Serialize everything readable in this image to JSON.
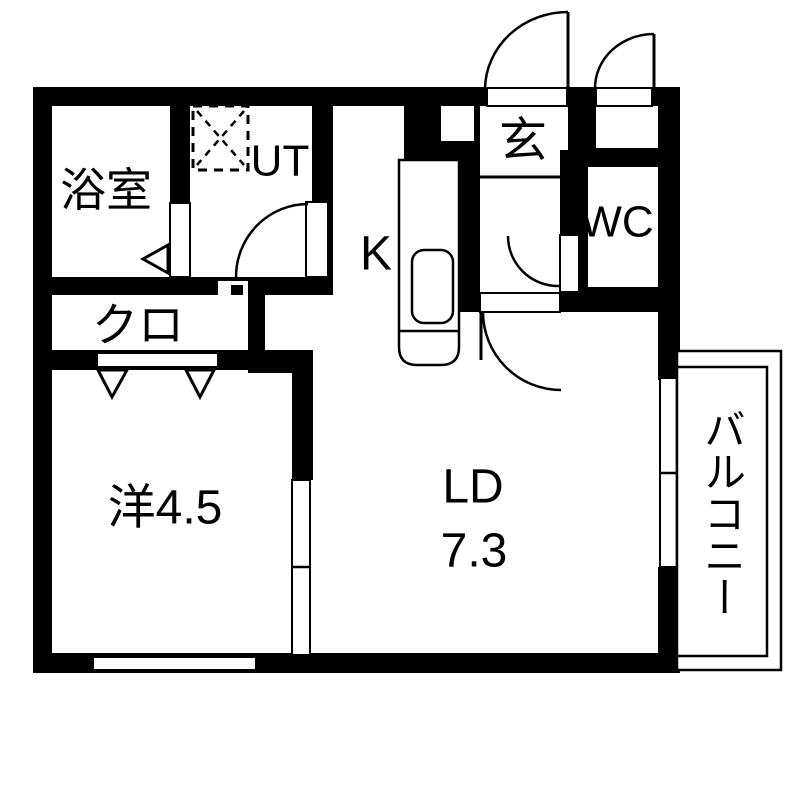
{
  "page": {
    "background": "#ffffff"
  },
  "floor_plan": {
    "type": "japanese-apartment-floorplan",
    "colors": {
      "wall": "#000000",
      "floor": "#ffffff",
      "line": "#000000"
    },
    "rooms": {
      "bath": "浴室",
      "utility": "UT",
      "kitchen": "K",
      "entrance": "玄",
      "toilet": "WC",
      "closet": "クロ",
      "western_room": "洋4.5",
      "living_dining_name": "LD",
      "living_dining_size": "7.3",
      "balcony": "バルコニー"
    }
  }
}
